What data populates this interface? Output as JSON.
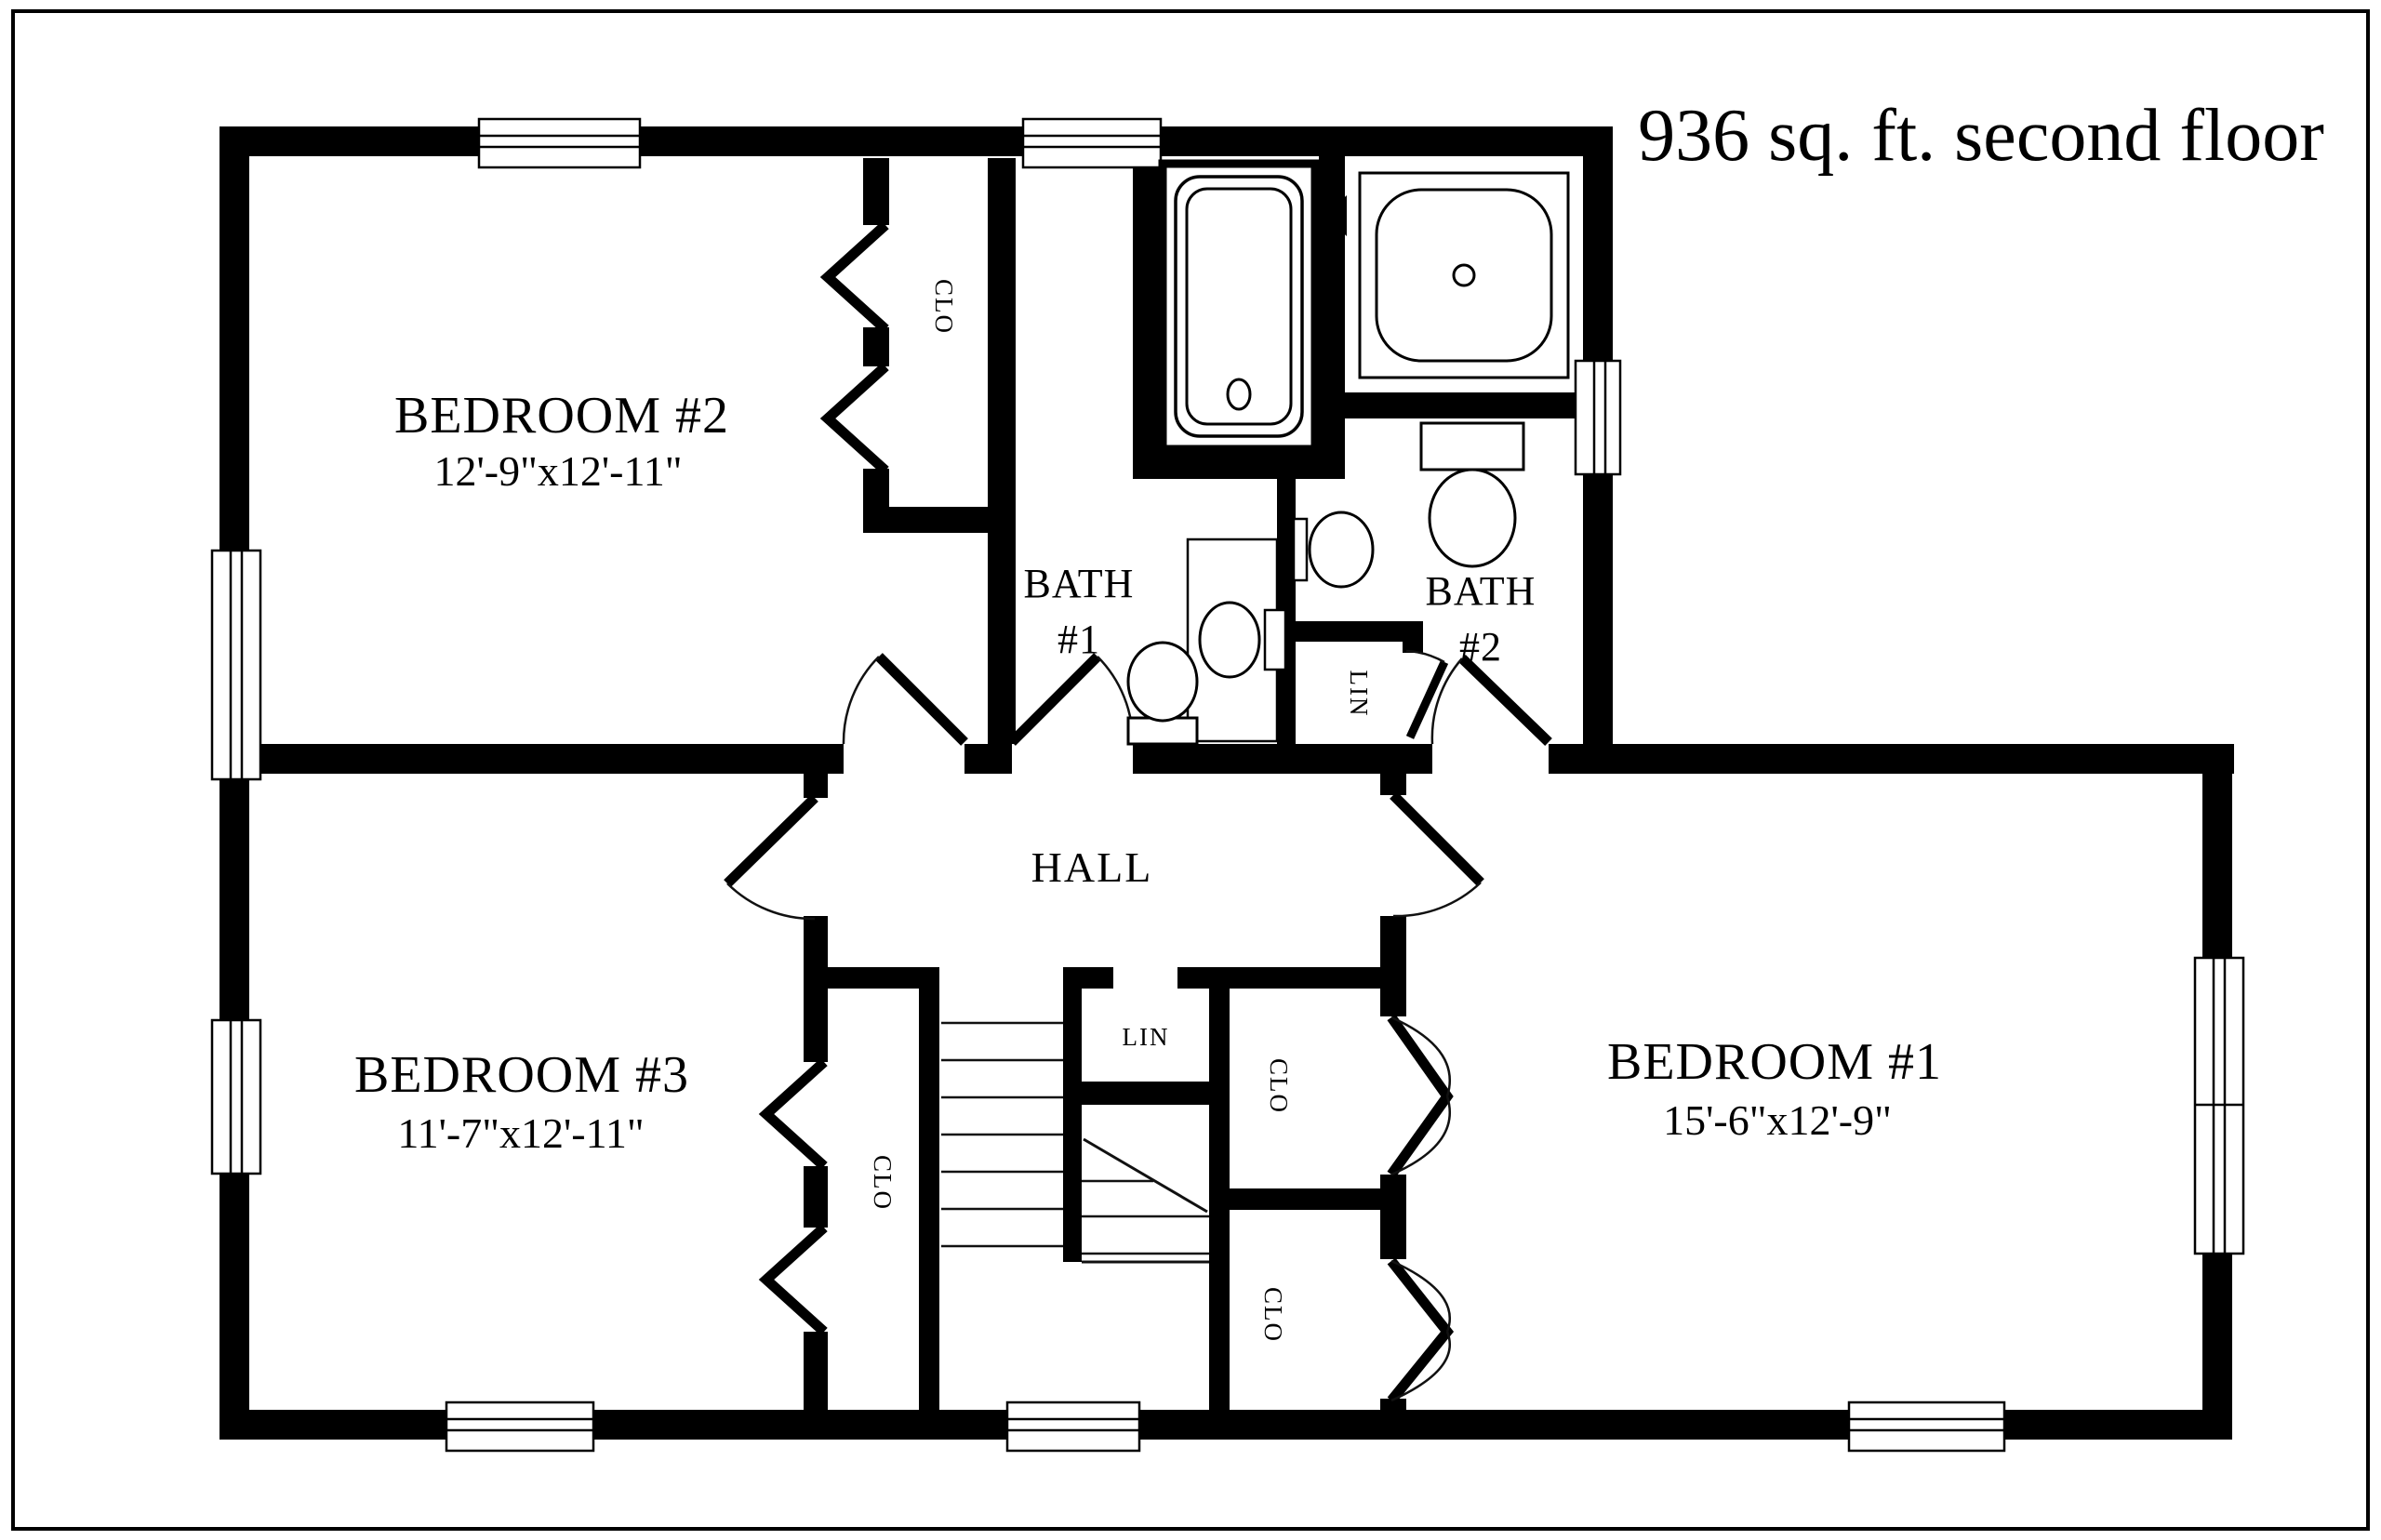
{
  "title": "936 sq. ft. second floor",
  "rooms": {
    "bedroom2": {
      "name": "BEDROOM #2",
      "dims": "12'-9\"x12'-11\""
    },
    "bedroom3": {
      "name": "BEDROOM #3",
      "dims": "11'-7\"x12'-11\""
    },
    "bedroom1": {
      "name": "BEDROOM #1",
      "dims": "15'-6\"x12'-9\""
    },
    "bath1": {
      "name": "BATH",
      "number": "#1"
    },
    "bath2": {
      "name": "BATH",
      "number": "#2"
    },
    "hall": {
      "name": "HALL"
    }
  },
  "closets": {
    "bedroom2_closet": "CLO",
    "bedroom3_closet": "CLO",
    "bedroom1_closet_upper": "CLO",
    "bedroom1_closet_lower": "CLO",
    "bath2_linen": "LIN",
    "hall_linen": "LIN"
  },
  "colors": {
    "walls": "#000000",
    "background": "#ffffff",
    "linework": "#111111"
  }
}
